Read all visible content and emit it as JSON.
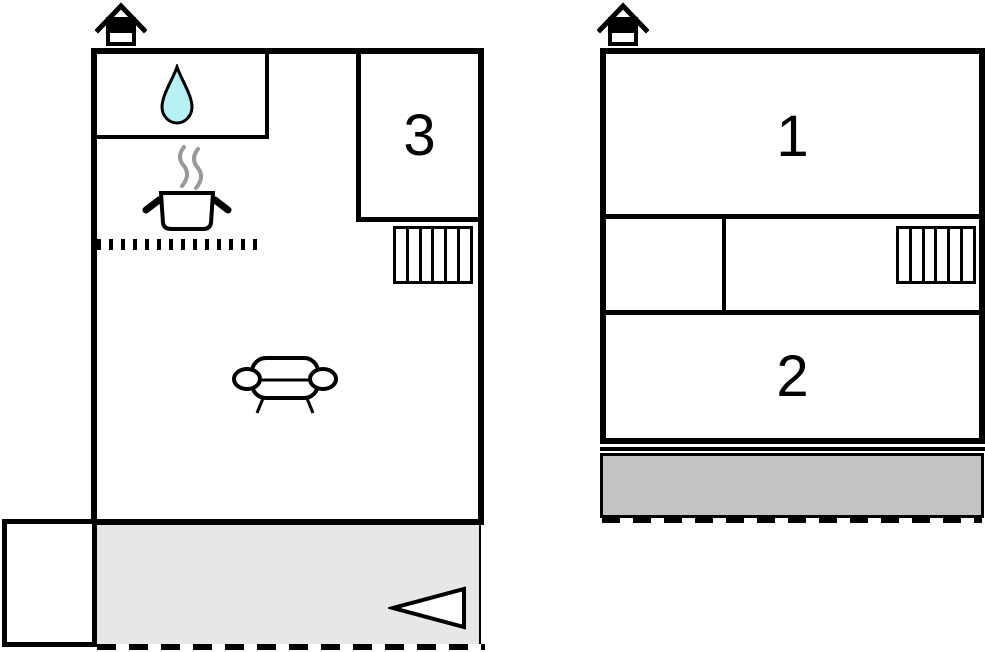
{
  "document": {
    "type": "floor-plan",
    "description": "Two floor plans of a holiday house, ground floor and upper floor"
  },
  "colors": {
    "wall": "#000000",
    "room_fill": "#ffffff",
    "water_drop_fill": "#b6f2f4",
    "steam": "#999999",
    "terrace_fill": "#e7e7e6",
    "balcony_fill": "#c3c3c3"
  },
  "ground_floor": {
    "name": "ground-floor-plan",
    "rooms": [
      {
        "id": "room-3",
        "label": "3"
      }
    ],
    "icons": [
      "house-icon",
      "water-drop-icon",
      "cooking-pot-icon",
      "stairs-icon",
      "sofa-icon",
      "arrow-left-icon"
    ]
  },
  "upper_floor": {
    "name": "upper-floor-plan",
    "rooms": [
      {
        "id": "room-1",
        "label": "1"
      },
      {
        "id": "room-2",
        "label": "2"
      }
    ],
    "icons": [
      "house-icon",
      "stairs-icon"
    ]
  }
}
